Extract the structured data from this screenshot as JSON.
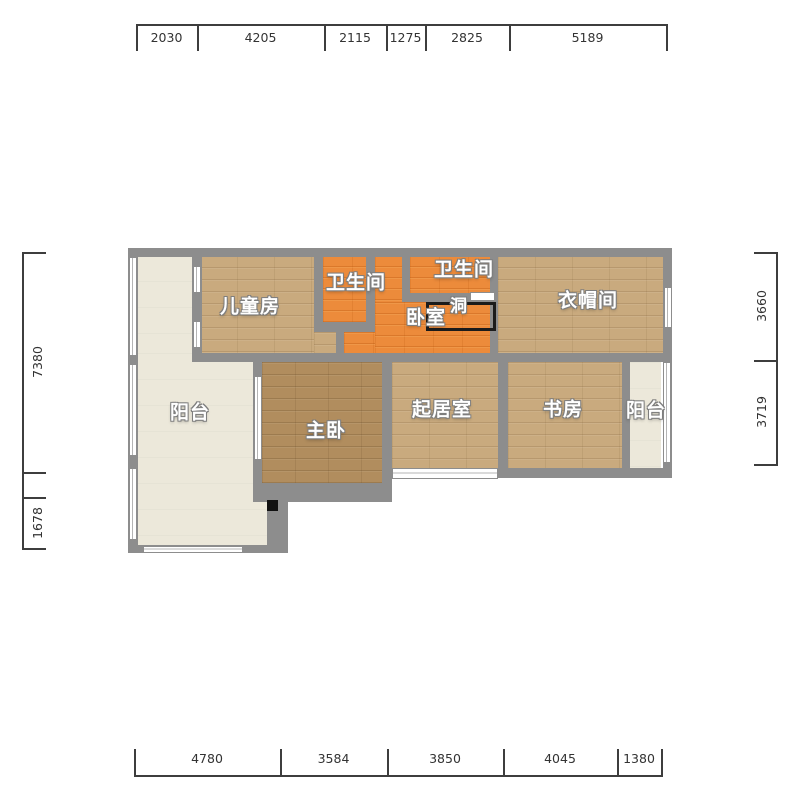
{
  "colors": {
    "wall": "#8d8d8d",
    "floor_wood_tan": "#c9aa7e",
    "floor_wood_brown": "#b18d5e",
    "floor_orange": "#ec8b3b",
    "floor_cream": "#ece8da",
    "dimension_text": "#333333",
    "hole_outline": "#1b1b1b"
  },
  "plan": {
    "floors": [
      {
        "name": "balcony-left-upper",
        "floor": "cream",
        "x": 138,
        "y": 255,
        "w": 56,
        "h": 107
      },
      {
        "name": "balcony-left-lower",
        "floor": "cream",
        "x": 138,
        "y": 353,
        "w": 129,
        "h": 192
      },
      {
        "name": "kids-room",
        "floor": "wood-tan",
        "x": 200,
        "y": 255,
        "w": 114,
        "h": 98
      },
      {
        "name": "kids-room-ext",
        "floor": "wood-tan",
        "x": 314,
        "y": 332,
        "w": 22,
        "h": 21
      },
      {
        "name": "bathroom-left",
        "floor": "orange",
        "x": 323,
        "y": 255,
        "w": 43,
        "h": 67
      },
      {
        "name": "corridor-strip",
        "floor": "orange",
        "x": 375,
        "y": 255,
        "w": 27,
        "h": 98
      },
      {
        "name": "bathroom-right",
        "floor": "orange",
        "x": 410,
        "y": 255,
        "w": 80,
        "h": 38
      },
      {
        "name": "bedroom-main",
        "floor": "orange",
        "x": 375,
        "y": 302,
        "w": 115,
        "h": 51
      },
      {
        "name": "bedroom-ext",
        "floor": "orange",
        "x": 344,
        "y": 332,
        "w": 31,
        "h": 21
      },
      {
        "name": "cloakroom",
        "floor": "wood-tan",
        "x": 498,
        "y": 255,
        "w": 165,
        "h": 98
      },
      {
        "name": "master-bedroom",
        "floor": "wood-brown",
        "x": 262,
        "y": 362,
        "w": 120,
        "h": 121
      },
      {
        "name": "living-room",
        "floor": "wood-tan",
        "x": 392,
        "y": 362,
        "w": 106,
        "h": 106
      },
      {
        "name": "study",
        "floor": "wood-tan",
        "x": 508,
        "y": 362,
        "w": 114,
        "h": 106
      },
      {
        "name": "balcony-right",
        "floor": "cream",
        "x": 630,
        "y": 362,
        "w": 31,
        "h": 106
      }
    ],
    "walls": [
      {
        "name": "top-outer",
        "x": 128,
        "y": 248,
        "w": 544,
        "h": 9
      },
      {
        "name": "left-outer",
        "x": 128,
        "y": 248,
        "w": 10,
        "h": 305
      },
      {
        "name": "right-outer",
        "x": 663,
        "y": 248,
        "w": 9,
        "h": 230
      },
      {
        "name": "middle-horizontal",
        "x": 192,
        "y": 353,
        "w": 480,
        "h": 9
      },
      {
        "name": "balcony-kids",
        "x": 192,
        "y": 255,
        "w": 10,
        "h": 107
      },
      {
        "name": "kids-bath-left",
        "x": 314,
        "y": 255,
        "w": 9,
        "h": 77
      },
      {
        "name": "bath-left-bottom",
        "x": 314,
        "y": 322,
        "w": 61,
        "h": 10
      },
      {
        "name": "bath-left-right",
        "x": 366,
        "y": 255,
        "w": 9,
        "h": 67
      },
      {
        "name": "kids-bedroom-stub",
        "x": 336,
        "y": 332,
        "w": 8,
        "h": 21
      },
      {
        "name": "bath-right-left-stub",
        "x": 402,
        "y": 255,
        "w": 8,
        "h": 47
      },
      {
        "name": "bath-right-bottom",
        "x": 402,
        "y": 293,
        "w": 88,
        "h": 9
      },
      {
        "name": "corridor-cloakroom",
        "x": 490,
        "y": 248,
        "w": 8,
        "h": 114
      },
      {
        "name": "balcony-master",
        "x": 253,
        "y": 362,
        "w": 9,
        "h": 140
      },
      {
        "name": "master-living",
        "x": 382,
        "y": 362,
        "w": 10,
        "h": 140
      },
      {
        "name": "living-study",
        "x": 498,
        "y": 362,
        "w": 10,
        "h": 116
      },
      {
        "name": "study-balcony",
        "x": 622,
        "y": 362,
        "w": 8,
        "h": 116
      },
      {
        "name": "bottom-right-section",
        "x": 498,
        "y": 468,
        "w": 174,
        "h": 10
      },
      {
        "name": "master-bottom",
        "x": 253,
        "y": 483,
        "w": 139,
        "h": 19
      },
      {
        "name": "balcony-lower-right",
        "x": 267,
        "y": 500,
        "w": 21,
        "h": 53
      },
      {
        "name": "balcony-bottom",
        "x": 128,
        "y": 545,
        "w": 160,
        "h": 8
      }
    ],
    "windows": [
      {
        "name": "left-wall-window-1",
        "o": "v",
        "x": 129,
        "y": 257,
        "w": 8,
        "h": 99
      },
      {
        "name": "left-wall-window-2",
        "o": "v",
        "x": 129,
        "y": 364,
        "w": 8,
        "h": 92
      },
      {
        "name": "left-wall-window-3",
        "o": "v",
        "x": 129,
        "y": 468,
        "w": 8,
        "h": 72
      },
      {
        "name": "kids-wall-window-1",
        "o": "v",
        "x": 193,
        "y": 266,
        "w": 8,
        "h": 27
      },
      {
        "name": "kids-wall-window-2",
        "o": "v",
        "x": 193,
        "y": 321,
        "w": 8,
        "h": 27
      },
      {
        "name": "master-wall-window",
        "o": "v",
        "x": 254,
        "y": 376,
        "w": 8,
        "h": 84
      },
      {
        "name": "balcony-bottom-window",
        "o": "h",
        "x": 143,
        "y": 546,
        "w": 100,
        "h": 7
      },
      {
        "name": "right-wall-window",
        "o": "v",
        "x": 664,
        "y": 287,
        "w": 8,
        "h": 41
      },
      {
        "name": "balcony-right-window",
        "o": "v",
        "x": 663,
        "y": 362,
        "w": 8,
        "h": 101
      },
      {
        "name": "living-bottom-window",
        "o": "h",
        "x": 392,
        "y": 468,
        "w": 106,
        "h": 11
      }
    ],
    "markers": {
      "hole_rect": {
        "x": 426,
        "y": 302,
        "w": 70,
        "h": 29
      },
      "shelf": {
        "x": 470,
        "y": 292,
        "w": 25,
        "h": 9
      },
      "black_square": {
        "x": 267,
        "y": 500,
        "w": 11,
        "h": 11
      }
    },
    "labels": [
      {
        "name": "kids-room-label",
        "text": "儿童房",
        "x": 250,
        "y": 307
      },
      {
        "name": "bathroom-left-label",
        "text": "卫生间",
        "x": 356,
        "y": 283
      },
      {
        "name": "bathroom-right-label",
        "text": "卫生间",
        "x": 464,
        "y": 270
      },
      {
        "name": "bedroom-label",
        "text": "卧室",
        "x": 426,
        "y": 318
      },
      {
        "name": "hole-label",
        "text": "洞",
        "x": 459,
        "y": 307,
        "small": true
      },
      {
        "name": "cloakroom-label",
        "text": "衣帽间",
        "x": 588,
        "y": 301
      },
      {
        "name": "balcony-left-label",
        "text": "阳台",
        "x": 190,
        "y": 413
      },
      {
        "name": "master-bedroom-label",
        "text": "主卧",
        "x": 326,
        "y": 431
      },
      {
        "name": "living-room-label",
        "text": "起居室",
        "x": 442,
        "y": 410
      },
      {
        "name": "study-label",
        "text": "书房",
        "x": 563,
        "y": 410
      },
      {
        "name": "balcony-right-label",
        "text": "阳台",
        "x": 646,
        "y": 411
      }
    ]
  },
  "dimensions": {
    "top": {
      "ticks": [
        136,
        197,
        324,
        386,
        425,
        509,
        666
      ],
      "labels": [
        "2030",
        "4205",
        "2115",
        "1275",
        "2825",
        "5189"
      ]
    },
    "bottom": {
      "ticks": [
        134,
        280,
        387,
        503,
        617,
        661
      ],
      "labels": [
        "4780",
        "3584",
        "3850",
        "4045",
        "1380"
      ]
    },
    "left": {
      "ticks": [
        252,
        472,
        497,
        548
      ],
      "labels": [
        "7380",
        "",
        "1678"
      ]
    },
    "right": {
      "ticks": [
        252,
        360,
        464
      ],
      "labels": [
        "3660",
        "3719"
      ]
    }
  }
}
